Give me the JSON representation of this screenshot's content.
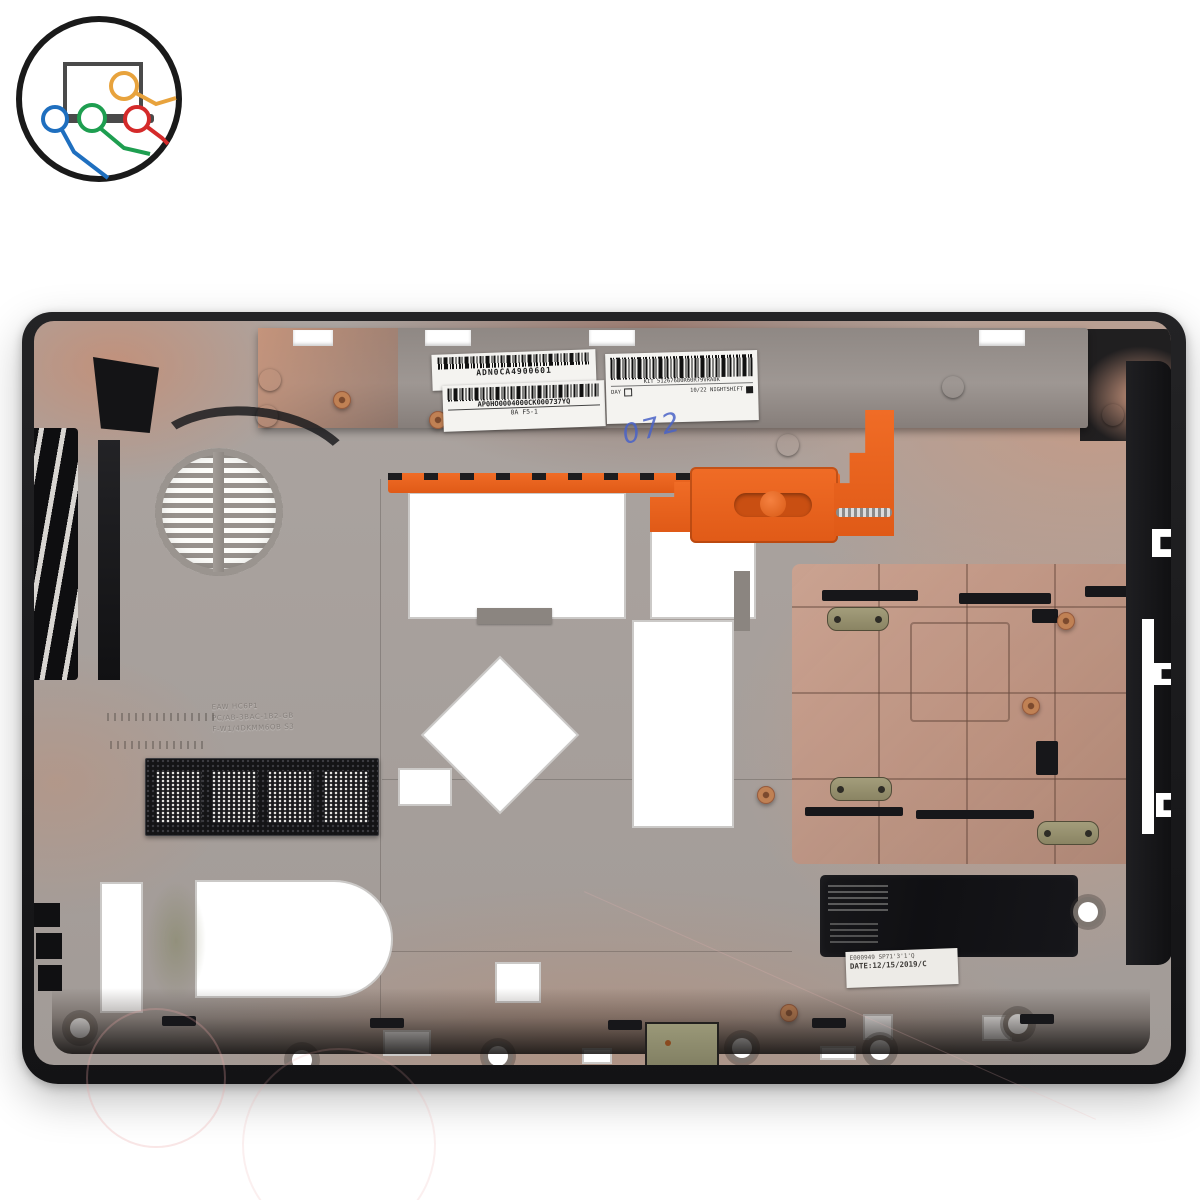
{
  "image": {
    "type": "product-photo",
    "subject": "laptop bottom base cover, inside view",
    "background_color": "#ffffff"
  },
  "logo": {
    "ring_color": "#1a1a1a",
    "laptop_color": "#4a4a4a",
    "cable_orange": "#e8a33d",
    "cable_blue": "#1f6fbf",
    "cable_green": "#1e9e50",
    "cable_red": "#d42a2a"
  },
  "labels": {
    "barcode_sticker_1": {
      "code": "ADN0CA4900601"
    },
    "barcode_sticker_2": {
      "code": "AP0HO0004000CK000737YQ",
      "subline": "0A    F5-1"
    },
    "kit_sticker": {
      "kit_line": "KIT  51267680R60R79VRA8K",
      "day_label": "DAY",
      "shift_label": "10/22  NIGHTSHIFT"
    },
    "handwritten_mark": "072",
    "date_sticker": {
      "line1": "E000949  SP71'3'1'Q",
      "line2": "DATE:12/15/2019/C"
    },
    "molded_text": {
      "line1": "EAW  HC6P1",
      "line2": "PC/AB-3BAC-1B2-GB",
      "line3": "F-W1/4DKMM6OB  S3"
    }
  },
  "palette": {
    "case_black": "#1d1d1f",
    "case_gray": "#a8a19d",
    "copper": "#c29a85",
    "orange_part": "#e8611c",
    "pad_black": "#141417"
  }
}
